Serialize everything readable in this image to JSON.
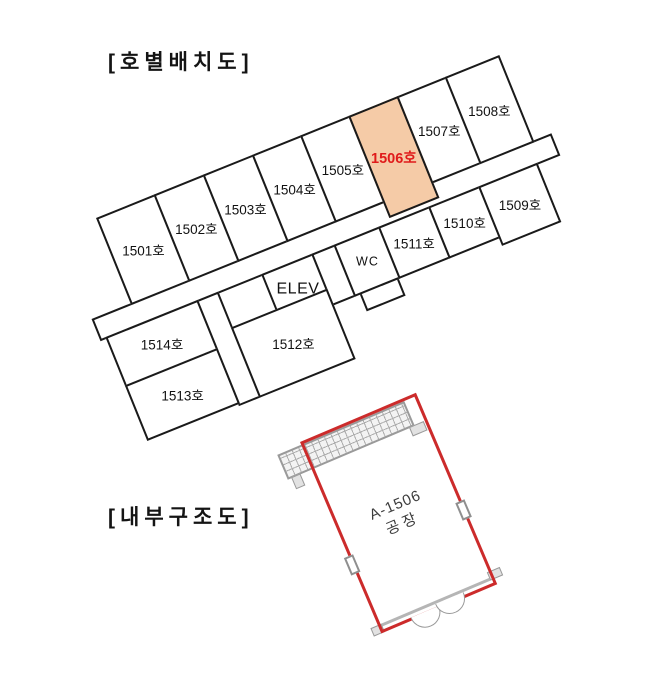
{
  "floor_plan": {
    "title": "[호별배치도]",
    "rooms": {
      "r1501": "1501호",
      "r1502": "1502호",
      "r1503": "1503호",
      "r1504": "1504호",
      "r1505": "1505호",
      "r1506": "1506호",
      "r1507": "1507호",
      "r1508": "1508호",
      "r1509": "1509호",
      "r1510": "1510호",
      "r1511": "1511호",
      "r1512": "1512호",
      "r1513": "1513호",
      "r1514": "1514호"
    },
    "elevator_label": "ELEV",
    "wc_label": "WC",
    "highlighted_room": "1506호",
    "highlight_fill_color": "#F5CBA7",
    "highlight_text_color": "#E01B1B",
    "line_color": "#1a1a1a"
  },
  "interior_plan": {
    "title": "[내부구조도]",
    "unit_label_line1": "A-1506",
    "unit_label_line2": "공장",
    "outline_color": "#CC2B2B"
  }
}
